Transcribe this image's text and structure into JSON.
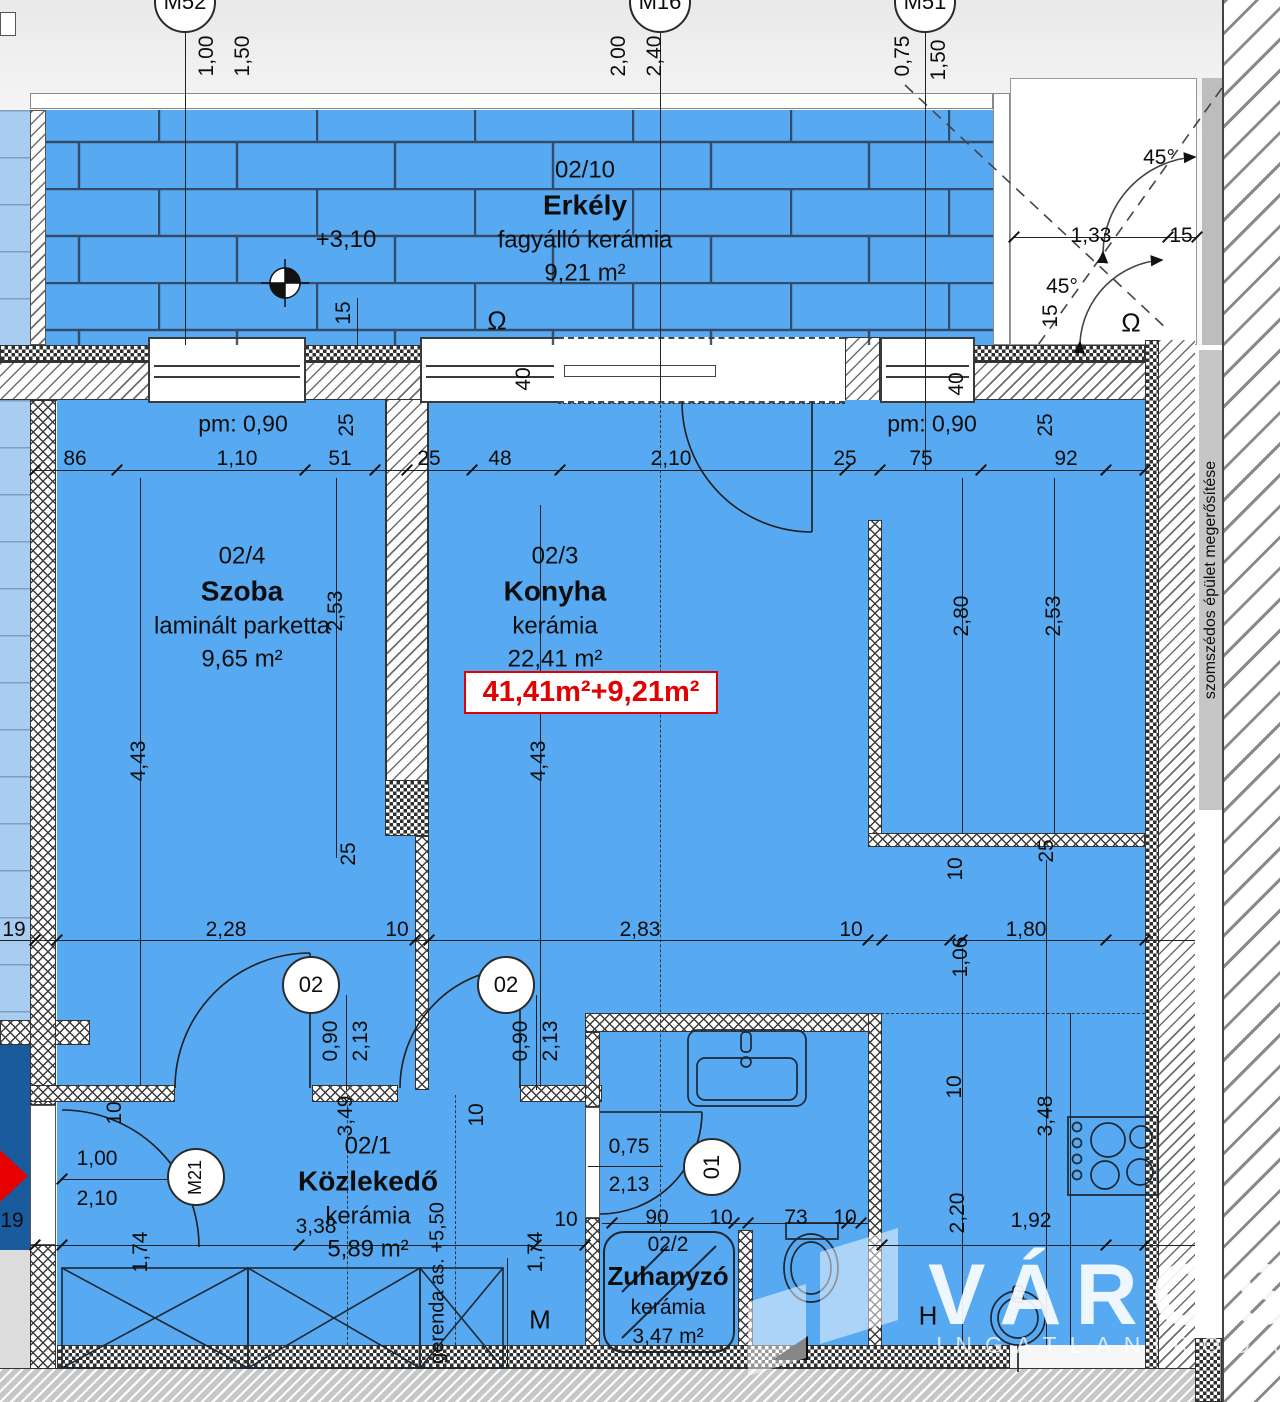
{
  "axis_markers": [
    {
      "label": "M52"
    },
    {
      "label": "M16"
    },
    {
      "label": "M51"
    }
  ],
  "rooms": {
    "erkely": {
      "id": "02/10",
      "name": "Erkély",
      "finish": "fagyálló kerámia",
      "area": "9,21 m²"
    },
    "szoba": {
      "id": "02/4",
      "name": "Szoba",
      "finish": "laminált parketta",
      "area": "9,65 m²"
    },
    "konyha": {
      "id": "02/3",
      "name": "Konyha",
      "finish": "kerámia",
      "area": "22,41 m²"
    },
    "kozlekedo": {
      "id": "02/1",
      "name": "Közlekedő",
      "finish": "kerámia",
      "area": "5,89 m²"
    },
    "zuhanyzo": {
      "id": "02/2",
      "name": "Zuhanyzó",
      "finish": "kerámia",
      "area": "3,47 m²"
    }
  },
  "summary": {
    "total_area": "41,41m²+9,21m²"
  },
  "annotations": {
    "level_balcony": "+3,10",
    "parapet_left": "pm: 0,90",
    "parapet_right": "pm: 0,90",
    "beam_note": "gerenda as. +5,50",
    "neighbor_note": "szomszédos épület megerősítése",
    "washer_label": "M",
    "fridge_label": "H",
    "vent_symbol": "Ω"
  },
  "door_tags": {
    "door_szoba": "02",
    "door_konyha": "02",
    "door_bath": "01",
    "door_entry": "M21"
  },
  "watermark": {
    "line1": "VÁROSI",
    "line2": "INGATLANIRODA"
  },
  "colors": {
    "floor_blue": "#57a9f1",
    "adjacent_lightblue": "#a9cdf0",
    "stairwell_darkblue": "#1a5b9e",
    "highlight_red": "#e20000"
  },
  "dimensions": [
    {
      "t": "1,00",
      "x": 207,
      "y": 56,
      "r": 1
    },
    {
      "t": "1,50",
      "x": 243,
      "y": 56,
      "r": 1
    },
    {
      "t": "2,00",
      "x": 619,
      "y": 56,
      "r": 1
    },
    {
      "t": "2,40",
      "x": 655,
      "y": 56,
      "r": 1
    },
    {
      "t": "0,75",
      "x": 903,
      "y": 56,
      "r": 1
    },
    {
      "t": "1,50",
      "x": 939,
      "y": 60,
      "r": 1
    },
    {
      "t": "15",
      "x": 344,
      "y": 313,
      "r": 1
    },
    {
      "t": "45°",
      "x": 1159,
      "y": 158,
      "r": 0
    },
    {
      "t": "1,33",
      "x": 1091,
      "y": 236,
      "r": 0
    },
    {
      "t": "15",
      "x": 1181,
      "y": 236,
      "r": 0
    },
    {
      "t": "45°",
      "x": 1062,
      "y": 287,
      "r": 0
    },
    {
      "t": "15",
      "x": 1051,
      "y": 316,
      "r": 1
    },
    {
      "t": "40",
      "x": 524,
      "y": 379,
      "r": 1
    },
    {
      "t": "40",
      "x": 957,
      "y": 384,
      "r": 1
    },
    {
      "t": "86",
      "x": 75,
      "y": 459,
      "r": 0
    },
    {
      "t": "1,10",
      "x": 237,
      "y": 459,
      "r": 0
    },
    {
      "t": "51",
      "x": 340,
      "y": 459,
      "r": 0
    },
    {
      "t": "25",
      "x": 429,
      "y": 459,
      "r": 0
    },
    {
      "t": "48",
      "x": 500,
      "y": 459,
      "r": 0
    },
    {
      "t": "2,10",
      "x": 671,
      "y": 459,
      "r": 0
    },
    {
      "t": "25",
      "x": 845,
      "y": 459,
      "r": 0
    },
    {
      "t": "75",
      "x": 921,
      "y": 459,
      "r": 0
    },
    {
      "t": "92",
      "x": 1066,
      "y": 459,
      "r": 0
    },
    {
      "t": "25",
      "x": 347,
      "y": 425,
      "r": 1
    },
    {
      "t": "25",
      "x": 1046,
      "y": 425,
      "r": 1
    },
    {
      "t": "2,53",
      "x": 336,
      "y": 611,
      "r": 1
    },
    {
      "t": "4,43",
      "x": 139,
      "y": 761,
      "r": 1
    },
    {
      "t": "25",
      "x": 349,
      "y": 854,
      "r": 1
    },
    {
      "t": "4,43",
      "x": 539,
      "y": 761,
      "r": 1
    },
    {
      "t": "2,80",
      "x": 962,
      "y": 616,
      "r": 1
    },
    {
      "t": "2,53",
      "x": 1054,
      "y": 616,
      "r": 1
    },
    {
      "t": "25",
      "x": 1047,
      "y": 851,
      "r": 1
    },
    {
      "t": "10",
      "x": 956,
      "y": 869,
      "r": 1
    },
    {
      "t": "19",
      "x": 14,
      "y": 930,
      "r": 0
    },
    {
      "t": "2,28",
      "x": 226,
      "y": 930,
      "r": 0
    },
    {
      "t": "10",
      "x": 397,
      "y": 930,
      "r": 0
    },
    {
      "t": "2,83",
      "x": 640,
      "y": 930,
      "r": 0
    },
    {
      "t": "10",
      "x": 851,
      "y": 930,
      "r": 0
    },
    {
      "t": "1,80",
      "x": 1026,
      "y": 930,
      "r": 0
    },
    {
      "t": "1,06",
      "x": 961,
      "y": 957,
      "r": 1
    },
    {
      "t": "0,90",
      "x": 331,
      "y": 1041,
      "r": 1
    },
    {
      "t": "2,13",
      "x": 361,
      "y": 1041,
      "r": 1
    },
    {
      "t": "0,90",
      "x": 521,
      "y": 1041,
      "r": 1
    },
    {
      "t": "2,13",
      "x": 551,
      "y": 1041,
      "r": 1
    },
    {
      "t": "10",
      "x": 955,
      "y": 1087,
      "r": 1
    },
    {
      "t": "10",
      "x": 115,
      "y": 1113,
      "r": 1
    },
    {
      "t": "10",
      "x": 477,
      "y": 1115,
      "r": 1
    },
    {
      "t": "3,49",
      "x": 346,
      "y": 1116,
      "r": 1
    },
    {
      "t": "3,48",
      "x": 1046,
      "y": 1116,
      "r": 1
    },
    {
      "t": "0,75",
      "x": 629,
      "y": 1147,
      "r": 0
    },
    {
      "t": "1,00",
      "x": 97,
      "y": 1159,
      "r": 0
    },
    {
      "t": "2,13",
      "x": 629,
      "y": 1185,
      "r": 0
    },
    {
      "t": "2,10",
      "x": 97,
      "y": 1199,
      "r": 0
    },
    {
      "t": "2,20",
      "x": 958,
      "y": 1213,
      "r": 1
    },
    {
      "t": "90",
      "x": 657,
      "y": 1218,
      "r": 0
    },
    {
      "t": "10",
      "x": 721,
      "y": 1218,
      "r": 0
    },
    {
      "t": "73",
      "x": 796,
      "y": 1218,
      "r": 0
    },
    {
      "t": "10",
      "x": 845,
      "y": 1218,
      "r": 0
    },
    {
      "t": "10",
      "x": 566,
      "y": 1220,
      "r": 0
    },
    {
      "t": "19",
      "x": 12,
      "y": 1221,
      "r": 0
    },
    {
      "t": "1,92",
      "x": 1031,
      "y": 1221,
      "r": 0
    },
    {
      "t": "3,38",
      "x": 316,
      "y": 1227,
      "r": 0
    },
    {
      "t": "1,74",
      "x": 141,
      "y": 1252,
      "r": 1
    },
    {
      "t": "1,74",
      "x": 536,
      "y": 1252,
      "r": 1
    }
  ]
}
